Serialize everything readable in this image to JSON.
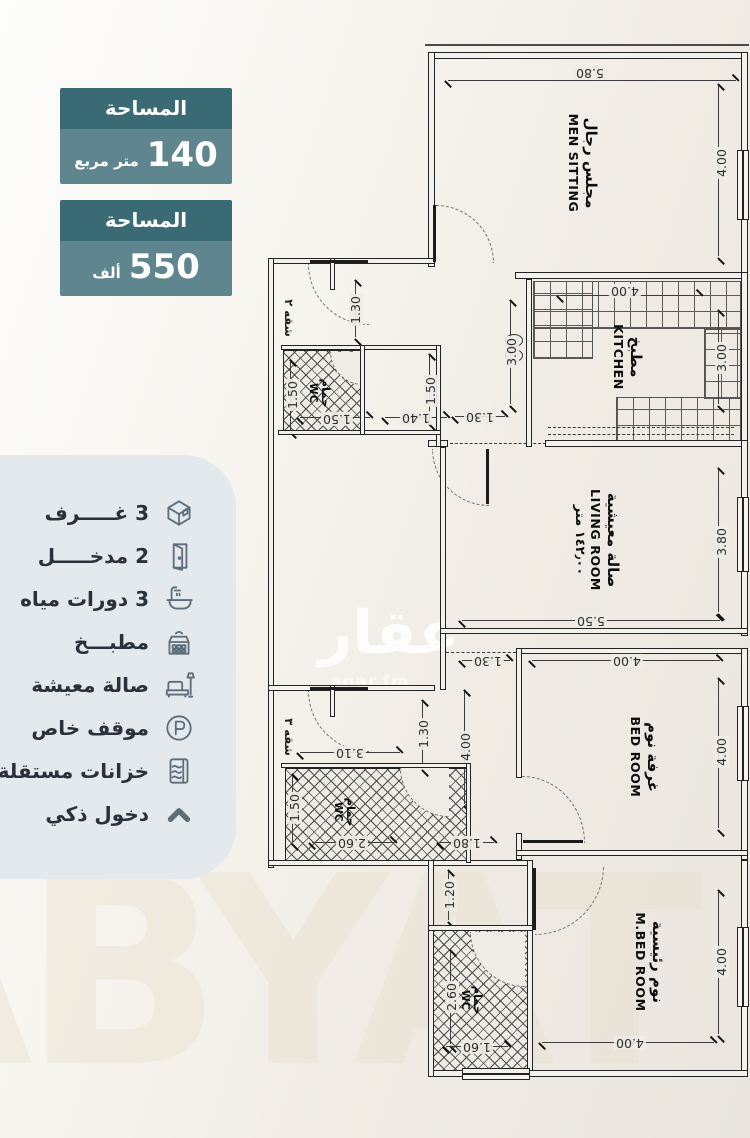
{
  "badges": [
    {
      "header": "المساحة",
      "value": "140",
      "unit": "متر مربع"
    },
    {
      "header": "المساحة",
      "value": "550",
      "unit": "ألف"
    }
  ],
  "features": [
    {
      "icon": "rooms-cube-icon",
      "label": "3 غـــــرف"
    },
    {
      "icon": "door-icon",
      "label": "2 مدخـــــل"
    },
    {
      "icon": "bathtub-icon",
      "label": "3 دورات مياه"
    },
    {
      "icon": "kitchen-stove-icon",
      "label": "مطبـــخ"
    },
    {
      "icon": "sofa-lamp-icon",
      "label": "صالة معيشة"
    },
    {
      "icon": "parking-icon",
      "label": "موقف خاص"
    },
    {
      "icon": "water-tank-icon",
      "label": "خزانات مستقلة"
    },
    {
      "icon": "smart-entry-icon",
      "label": "دخول ذكي"
    }
  ],
  "plan": {
    "rooms": {
      "men": {
        "ar": "مجلس رجال",
        "en": "MEN SITTING"
      },
      "kitchen": {
        "ar": "مطبخ",
        "en": "KITCHEN"
      },
      "living": {
        "ar": "صالة معيشية",
        "en": "LIVING ROOM",
        "area": "١٤٢٫٠٠ متر"
      },
      "bed": {
        "ar": "غرفة نوم",
        "en": "BED ROOM"
      },
      "mbed": {
        "ar": "نوم رئيسية",
        "en": "M.BED ROOM"
      },
      "wc_top": {
        "ar": "حمام",
        "en": "WC"
      },
      "wc_mid": {
        "ar": "حمام",
        "en": "WC"
      },
      "wc_bottom": {
        "ar": "حمام",
        "en": "WC"
      }
    },
    "apartments": {
      "top": "شقه ٢",
      "mid": "شقه ٣"
    },
    "dims": [
      "5.80",
      "4.00",
      "4.00",
      "3.00",
      "3.00",
      "1.30",
      "1.50",
      "1.50",
      "1.40",
      "1.50",
      "1.30",
      "3.80",
      "5.50",
      "4.00",
      "1.30",
      "4.00",
      "4.00",
      "1.80",
      "3.10",
      "1.30",
      "1.50",
      "2.60",
      "1.20",
      "2.60",
      "1.60",
      "4.00",
      "4.00"
    ],
    "watermark": {
      "logo": "عقار",
      "sub": "aqar.fm",
      "big": "ABYAT"
    }
  },
  "colors": {
    "badge_header": "#3a6a73",
    "badge_body": "#5f858e",
    "panel_bg": "#e3e9ec",
    "plan_bg": "#efece6",
    "wall": "#232323"
  }
}
